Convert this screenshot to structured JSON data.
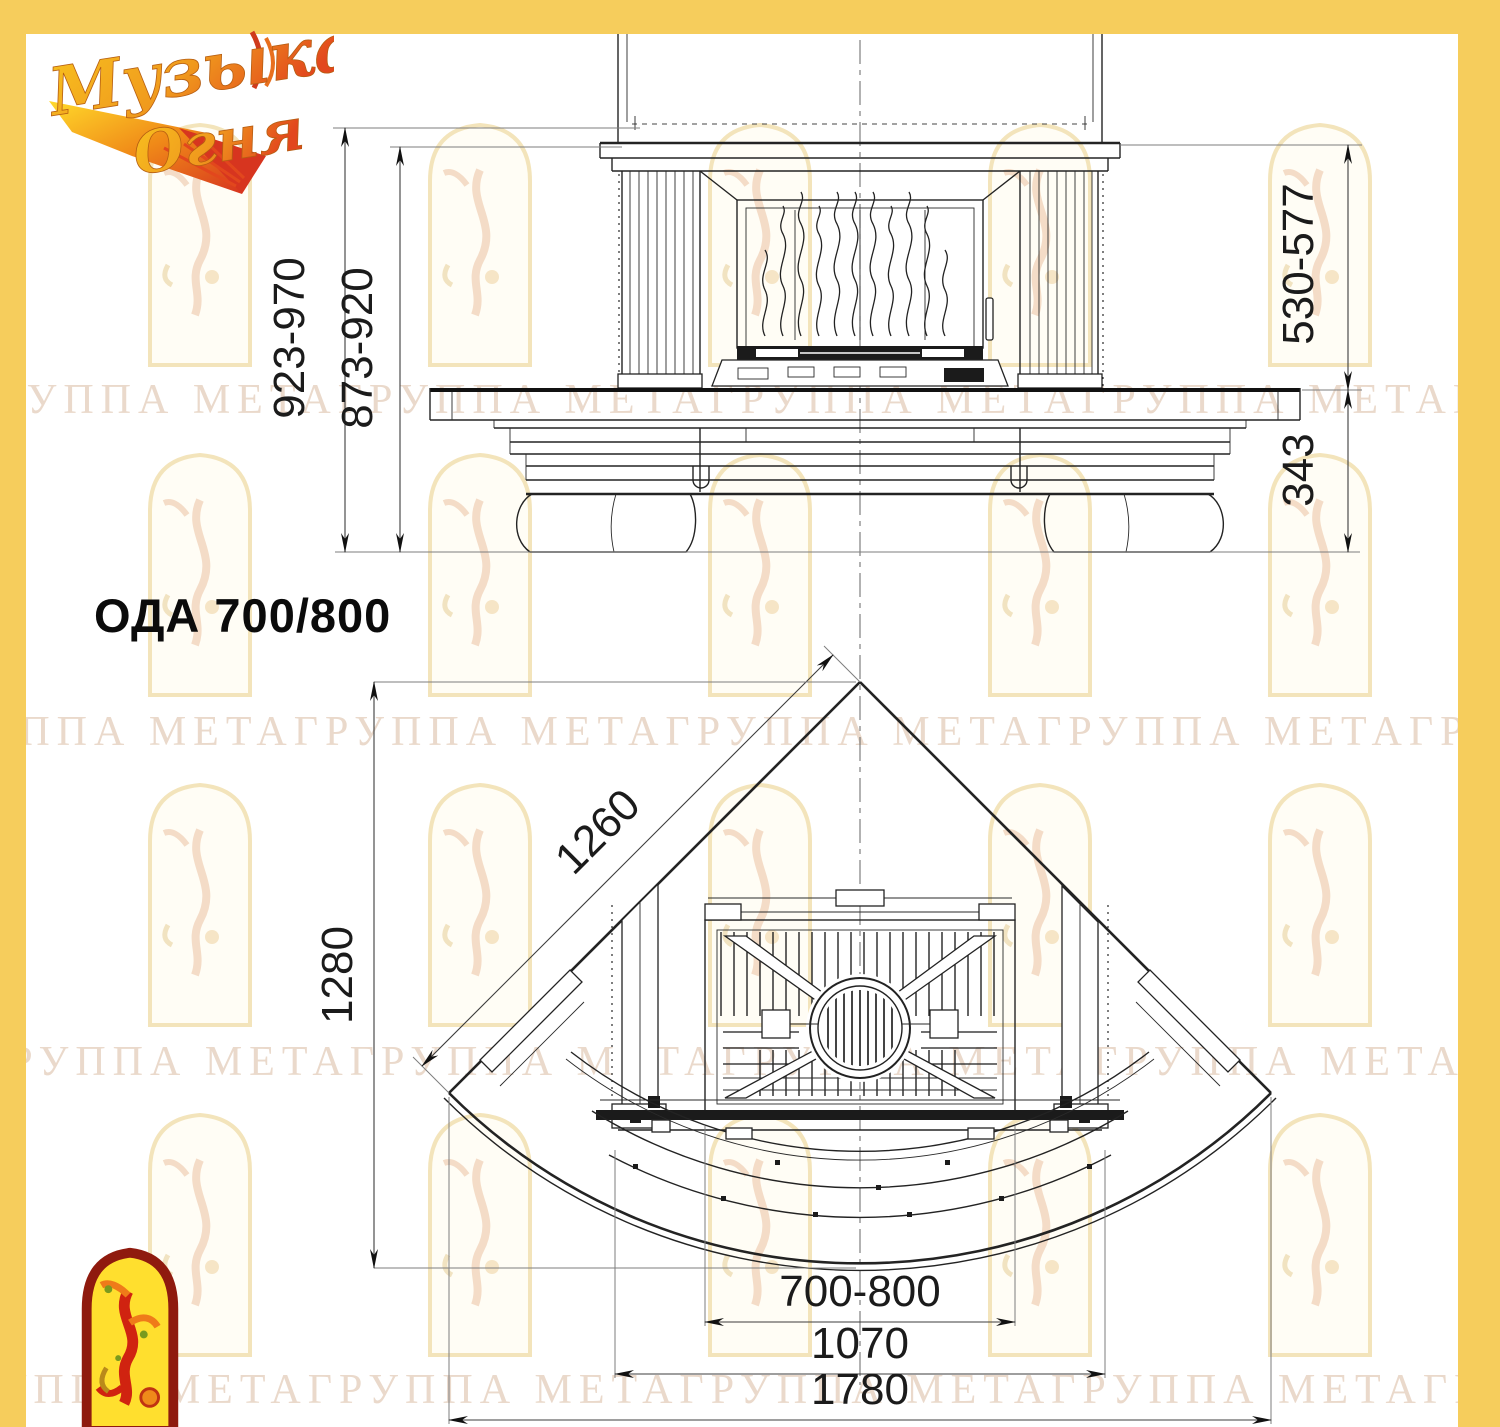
{
  "page": {
    "background": "#ffffff",
    "border_color": "#f6cd5c",
    "line_color": "#232323"
  },
  "logo": {
    "word1": "Музыка",
    "word2": "Огня"
  },
  "title": "ОДА 700/800",
  "watermark": {
    "unit": "ГРУППА МЕТА",
    "row_text": "ГРУППА МЕТАГРУППА МЕТАГРУППА МЕТАГРУППА МЕТАГРУППА МЕТАГРУППА МЕТА"
  },
  "front_view": {
    "label": "front elevation of fireplace",
    "dims": {
      "height_overall": "923-970",
      "height_body": "873-920",
      "height_upper": "530-577",
      "height_base": "343"
    }
  },
  "plan_view": {
    "label": "plan view of corner fireplace",
    "dims": {
      "side_wall": "1260",
      "depth": "1280",
      "firebox_width": "700-800",
      "hearth_width": "1070",
      "overall_width": "1780"
    }
  }
}
